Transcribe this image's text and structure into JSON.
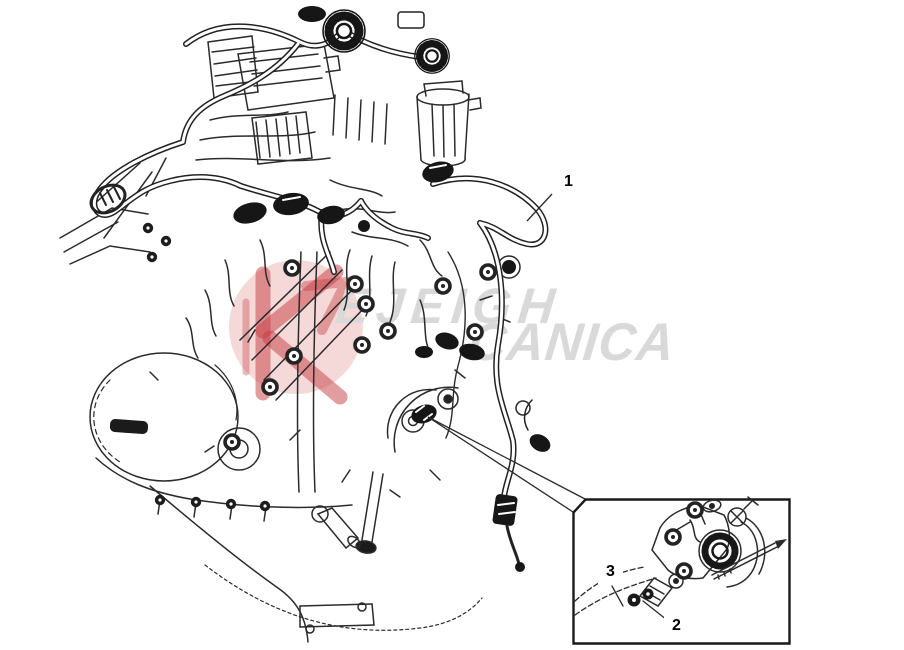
{
  "canvas": {
    "background": "#ffffff",
    "ink_color": "#2b2b2b",
    "description_visible_elements": "engine wiring harness line drawing with detail inset box"
  },
  "callouts": {
    "item1": {
      "label": "1"
    },
    "item2": {
      "label": "2"
    },
    "item3": {
      "label": "3"
    }
  },
  "watermark": {
    "line1": "EJEIGH",
    "line2": "CANICA",
    "text_color": "#d9d9d9",
    "logo_circle_color": "#f5d8d8",
    "logo_mark_color": "#c63b40"
  }
}
